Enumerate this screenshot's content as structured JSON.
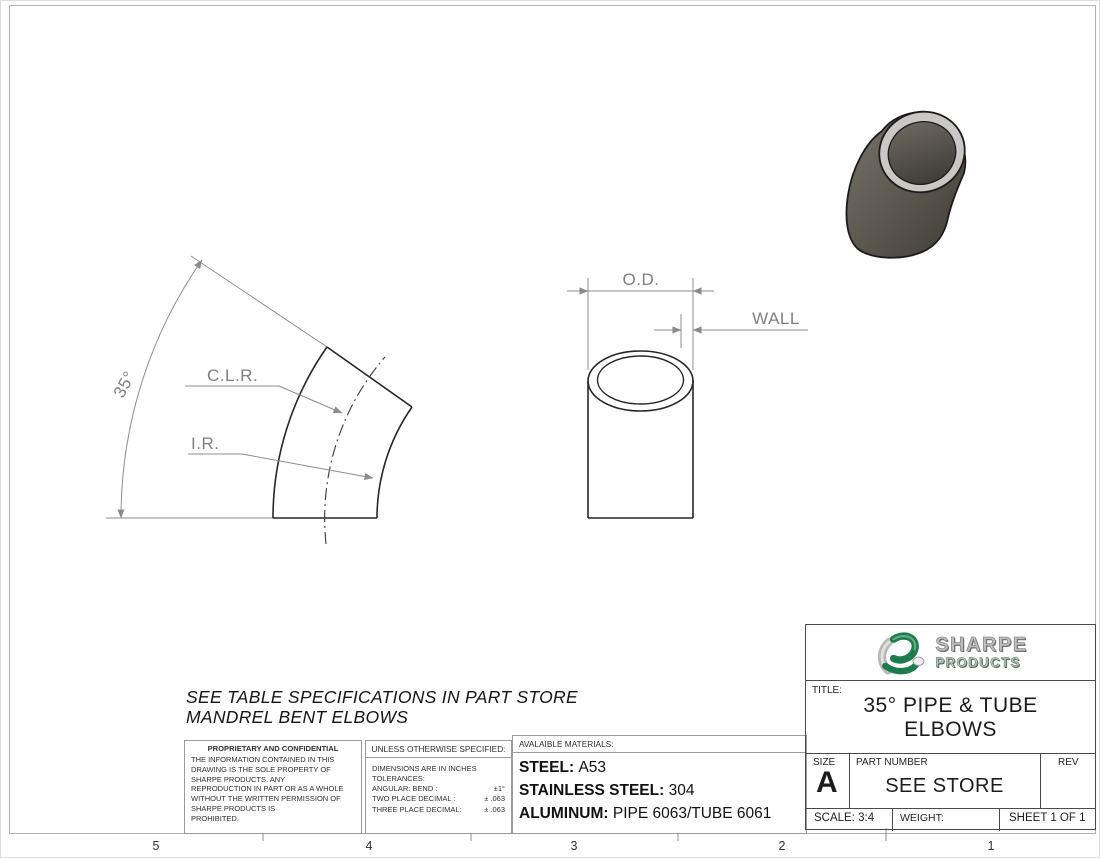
{
  "sheet": {
    "zone_labels": [
      "5",
      "4",
      "3",
      "2",
      "1"
    ],
    "note": {
      "line1": "SEE TABLE SPECIFICATIONS IN PART STORE",
      "line2": "MANDREL BENT ELBOWS"
    }
  },
  "views": {
    "elbow_labels": {
      "angle": "35°",
      "clr": "C.L.R.",
      "ir": "I.R."
    },
    "tube_labels": {
      "od": "O.D.",
      "wall": "WALL"
    }
  },
  "proprietary": {
    "header": "PROPRIETARY AND CONFIDENTIAL",
    "lines": [
      "THE INFORMATION CONTAINED IN THIS",
      "DRAWING IS THE SOLE PROPERTY OF",
      "SHARPE PRODUCTS.  ANY",
      "REPRODUCTION IN PART OR AS A WHOLE",
      "WITHOUT THE WRITTEN PERMISSION OF",
      "SHARPE PRODUCTS IS",
      "PROHIBITED."
    ]
  },
  "tolerances": {
    "header": "UNLESS OTHERWISE SPECIFIED:",
    "line1": "DIMENSIONS ARE IN INCHES",
    "line2": "TOLERANCES:",
    "rows": [
      {
        "label": "ANGULAR: BEND :",
        "value": "±1°"
      },
      {
        "label": "TWO PLACE DECIMAL :",
        "value": "± .063"
      },
      {
        "label": "THREE PLACE DECIMAL:",
        "value": "± .063"
      }
    ]
  },
  "materials": {
    "header": "AVALAIBLE MATERIALS:",
    "items": [
      {
        "label": "STEEL:",
        "value": "A53"
      },
      {
        "label": "STAINLESS STEEL:",
        "value": "304"
      },
      {
        "label": "ALUMINUM:",
        "value": "PIPE 6063/TUBE 6061"
      }
    ]
  },
  "title_block": {
    "logo": {
      "word1": "SHARPE",
      "word2": "PRODUCTS",
      "accent_green": "#1e7b4d"
    },
    "title_label": "TITLE:",
    "title_line1": "35° PIPE & TUBE",
    "title_line2": "ELBOWS",
    "size_label": "SIZE",
    "size_value": "A",
    "part_number_label": "PART NUMBER",
    "part_number_value": "SEE STORE",
    "rev_label": "REV",
    "scale": "SCALE: 3:4",
    "weight_label": "WEIGHT:",
    "sheet_info": "SHEET 1 OF 1"
  }
}
